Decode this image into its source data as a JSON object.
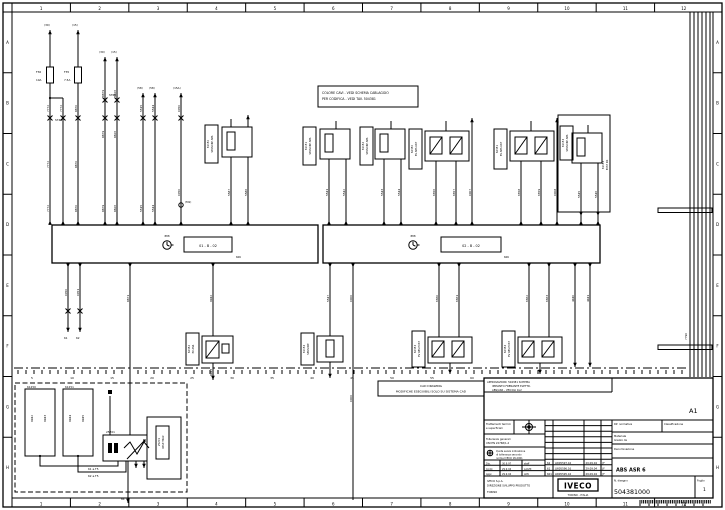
{
  "meta": {
    "ink": "#000000",
    "bg": "#ffffff",
    "drawing_type": "wiring-schematic"
  },
  "frame": {
    "top_zones": [
      "1",
      "2",
      "3",
      "4",
      "5",
      "6",
      "7",
      "8",
      "9",
      "10",
      "11",
      "12"
    ],
    "bottom_zones": [
      "1",
      "2",
      "3",
      "4",
      "5",
      "6",
      "7",
      "8",
      "9",
      "10",
      "11",
      "12"
    ],
    "left_zones": [
      "A",
      "B",
      "C",
      "D",
      "E",
      "F",
      "G",
      "H"
    ],
    "right_zones": [
      "A",
      "B",
      "C",
      "D",
      "E",
      "F",
      "G",
      "H"
    ]
  },
  "note_box": {
    "line1": "COLORE CAVI - VEDI SCHEMA CABLAGGIO",
    "line2": "PER CODIFICA - VEDI TAV. 504381"
  },
  "cad_box": {
    "line1": "CAD DRAWING",
    "line2": "MODIFICHE ESEGUIBILI SOLO SU SISTEMA CAD"
  },
  "ecus": {
    "left": {
      "ref": "01 - B - 02",
      "tag": "606",
      "clock_label": "888"
    },
    "right": {
      "ref": "02 - B - 02",
      "tag": "606",
      "clock_label": "888"
    }
  },
  "titleblock": {
    "top_note1": "APPROVAZIONI: 504381 SCHEMA",
    "top_note2": "IMPIANTO FRENANTE ELETTR.",
    "top_note3": "ABS/ASR - VEICOLI 4x2",
    "sheet_ref": "A1",
    "treat1": "Trattamenti termici",
    "treat2": "e superficiali",
    "gen1": "Tolleranze generali",
    "gen2": "UNI EN 22768/1-2",
    "tol1": "Quote senza indicazione",
    "tol2": "di tolleranza secondo",
    "tol3": "norme IVECO 18-2001",
    "norm_label": "Rif. normativa",
    "class_label": "Classificazione",
    "mat1": "Materiale",
    "mat2": "Grezzo da",
    "den_label": "Denominazione",
    "desc": "ABS ASR 6",
    "revisions": [
      {
        "n": "62",
        "desc": "LW05597.16",
        "date": "29.09.04",
        "sig": "JF"
      },
      {
        "n": "61",
        "desc": "LW05596.16",
        "date": "29.09.04",
        "sig": "JF"
      },
      {
        "n": "601",
        "desc": "LW05595.16",
        "date": "29.09.04",
        "sig": "JF"
      }
    ],
    "sign_rows": [
      {
        "role": "Dis.",
        "date": "30.9.97",
        "name": "staff"
      },
      {
        "role": "Contr.",
        "date": "29.9.04",
        "name": "LAGHI"
      },
      {
        "role": "Appr.",
        "date": "29.9.04",
        "name": "ADV"
      }
    ],
    "company1": "IVECO S.p.A.",
    "company2": "DIREZIONE SVILUPPO PRODOTTO",
    "company3": "TORINO",
    "logo": "IVECO",
    "logo_sub": "TORINO - ITALIA",
    "dwg_label": "N. disegno",
    "dwg_no": "504381000",
    "sheet_label": "Foglio",
    "sheet_no": "1"
  },
  "chassis_marks": [
    "5",
    "10",
    "15",
    "20",
    "25",
    "30",
    "35",
    "40",
    "45",
    "50",
    "55",
    "60"
  ],
  "component_labels": [
    {
      "x": 211,
      "y": 144,
      "l1": "61150",
      "l2": "SENSORE ABS"
    },
    {
      "x": 309,
      "y": 146,
      "l1": "61151",
      "l2": "SENSORE ABS"
    },
    {
      "x": 366,
      "y": 146,
      "l1": "61152",
      "l2": "SENSORE ABS"
    },
    {
      "x": 415,
      "y": 149,
      "l1": "62350",
      "l2": "EV ABS ANT"
    },
    {
      "x": 500,
      "y": 149,
      "l1": "62351",
      "l2": "EV ABS ANT"
    },
    {
      "x": 566,
      "y": 143,
      "l1": "61153",
      "l2": "SENSORE ABS"
    },
    {
      "x": 606,
      "y": 165,
      "l1": "61153",
      "l2": "POST DX"
    },
    {
      "x": 192,
      "y": 349,
      "l1": "62352",
      "l2": "EV ASR"
    },
    {
      "x": 307,
      "y": 349,
      "l1": "61154",
      "l2": "SENSORE"
    },
    {
      "x": 418,
      "y": 349,
      "l1": "62353",
      "l2": "EV ABS POST"
    },
    {
      "x": 508,
      "y": 349,
      "l1": "62354",
      "l2": "EV ABS POST"
    },
    {
      "x": 162,
      "y": 442,
      "l1": "25201",
      "l2": "RELE TRAZ"
    }
  ],
  "wire_labels": [
    {
      "x": 44,
      "y": 26,
      "t": "(30)"
    },
    {
      "x": 72,
      "y": 26,
      "t": "(15)"
    },
    {
      "x": 99,
      "y": 53,
      "t": "(30)"
    },
    {
      "x": 111,
      "y": 53,
      "t": "(15)"
    },
    {
      "x": 137,
      "y": 89,
      "t": "(58)"
    },
    {
      "x": 149,
      "y": 89,
      "t": "(58)"
    },
    {
      "x": 173,
      "y": 89,
      "t": "(15A)"
    },
    {
      "x": 36,
      "y": 73,
      "t": "F36"
    },
    {
      "x": 36,
      "y": 81,
      "t": "10A"
    },
    {
      "x": 64,
      "y": 73,
      "t": "F35"
    },
    {
      "x": 64,
      "y": 81,
      "t": "7.5A"
    },
    {
      "x": 55,
      "y": 121,
      "t": "ST40"
    },
    {
      "x": 109,
      "y": 96,
      "t": "ST60"
    },
    {
      "x": 49,
      "y": 112,
      "t": "7772",
      "r": 1
    },
    {
      "x": 62,
      "y": 112,
      "t": "7772",
      "r": 1
    },
    {
      "x": 77,
      "y": 112,
      "t": "8870",
      "r": 1
    },
    {
      "x": 104,
      "y": 97,
      "t": "8879",
      "r": 1
    },
    {
      "x": 116,
      "y": 97,
      "t": "8826",
      "r": 1
    },
    {
      "x": 104,
      "y": 138,
      "t": "8879",
      "r": 1
    },
    {
      "x": 116,
      "y": 138,
      "t": "8826",
      "r": 1
    },
    {
      "x": 142,
      "y": 112,
      "t": "5515",
      "r": 1
    },
    {
      "x": 154,
      "y": 112,
      "t": "5544",
      "r": 1
    },
    {
      "x": 180,
      "y": 112,
      "t": "0050",
      "r": 1
    },
    {
      "x": 49,
      "y": 168,
      "t": "7772",
      "r": 1
    },
    {
      "x": 77,
      "y": 168,
      "t": "8870",
      "r": 1
    },
    {
      "x": 49,
      "y": 212,
      "t": "7772",
      "r": 1
    },
    {
      "x": 77,
      "y": 212,
      "t": "8870",
      "r": 1
    },
    {
      "x": 104,
      "y": 212,
      "t": "8879",
      "r": 1
    },
    {
      "x": 116,
      "y": 212,
      "t": "8826",
      "r": 1
    },
    {
      "x": 142,
      "y": 212,
      "t": "5515",
      "r": 1
    },
    {
      "x": 154,
      "y": 212,
      "t": "5544",
      "r": 1
    },
    {
      "x": 180,
      "y": 196,
      "t": "0050",
      "r": 1
    },
    {
      "x": 185,
      "y": 203,
      "t": "(M1)"
    },
    {
      "x": 230,
      "y": 196,
      "t": "5587",
      "r": 1
    },
    {
      "x": 247,
      "y": 196,
      "t": "5586",
      "r": 1
    },
    {
      "x": 328,
      "y": 196,
      "t": "5541",
      "r": 1
    },
    {
      "x": 345,
      "y": 196,
      "t": "5542",
      "r": 1
    },
    {
      "x": 383,
      "y": 196,
      "t": "5543",
      "r": 1
    },
    {
      "x": 400,
      "y": 196,
      "t": "5544",
      "r": 1
    },
    {
      "x": 435,
      "y": 196,
      "t": "6656",
      "r": 1
    },
    {
      "x": 455,
      "y": 196,
      "t": "6657",
      "r": 1
    },
    {
      "x": 471,
      "y": 196,
      "t": "0007",
      "r": 1
    },
    {
      "x": 520,
      "y": 196,
      "t": "6658",
      "r": 1
    },
    {
      "x": 540,
      "y": 196,
      "t": "6659",
      "r": 1
    },
    {
      "x": 556,
      "y": 196,
      "t": "0008",
      "r": 1
    },
    {
      "x": 580,
      "y": 198,
      "t": "5545",
      "r": 1
    },
    {
      "x": 597,
      "y": 198,
      "t": "5546",
      "r": 1
    },
    {
      "x": 67,
      "y": 296,
      "t": "0050",
      "r": 1
    },
    {
      "x": 79,
      "y": 296,
      "t": "0051",
      "r": 1
    },
    {
      "x": 129,
      "y": 302,
      "t": "8871",
      "r": 1
    },
    {
      "x": 212,
      "y": 302,
      "t": "9942",
      "r": 1
    },
    {
      "x": 212,
      "y": 376,
      "t": "9943",
      "r": 1
    },
    {
      "x": 329,
      "y": 302,
      "t": "5547",
      "r": 1
    },
    {
      "x": 352,
      "y": 302,
      "t": "0000",
      "r": 1
    },
    {
      "x": 352,
      "y": 402,
      "t": "0000",
      "r": 1
    },
    {
      "x": 438,
      "y": 302,
      "t": "6660",
      "r": 1
    },
    {
      "x": 458,
      "y": 302,
      "t": "6661",
      "r": 1
    },
    {
      "x": 528,
      "y": 302,
      "t": "6662",
      "r": 1
    },
    {
      "x": 548,
      "y": 302,
      "t": "6663",
      "r": 1
    },
    {
      "x": 574,
      "y": 302,
      "t": "4440",
      "r": 1
    },
    {
      "x": 589,
      "y": 302,
      "t": "4441",
      "r": 1
    },
    {
      "x": 687,
      "y": 340,
      "t": "7790",
      "r": 1
    },
    {
      "x": 64,
      "y": 339,
      "t": "61"
    },
    {
      "x": 76,
      "y": 339,
      "t": "62"
    },
    {
      "x": 27,
      "y": 388,
      "t": "61250"
    },
    {
      "x": 65,
      "y": 388,
      "t": "61251"
    },
    {
      "x": 33,
      "y": 422,
      "t": "9942",
      "r": 1
    },
    {
      "x": 46,
      "y": 422,
      "t": "9943",
      "r": 1
    },
    {
      "x": 71,
      "y": 422,
      "t": "9944",
      "r": 1
    },
    {
      "x": 84,
      "y": 422,
      "t": "9945",
      "r": 1
    },
    {
      "x": 88,
      "y": 470,
      "t": "61 a.T5"
    },
    {
      "x": 88,
      "y": 477,
      "t": "62 a.T5"
    },
    {
      "x": 121,
      "y": 500,
      "t": "84"
    },
    {
      "x": 106,
      "y": 433,
      "t": "25201"
    }
  ]
}
